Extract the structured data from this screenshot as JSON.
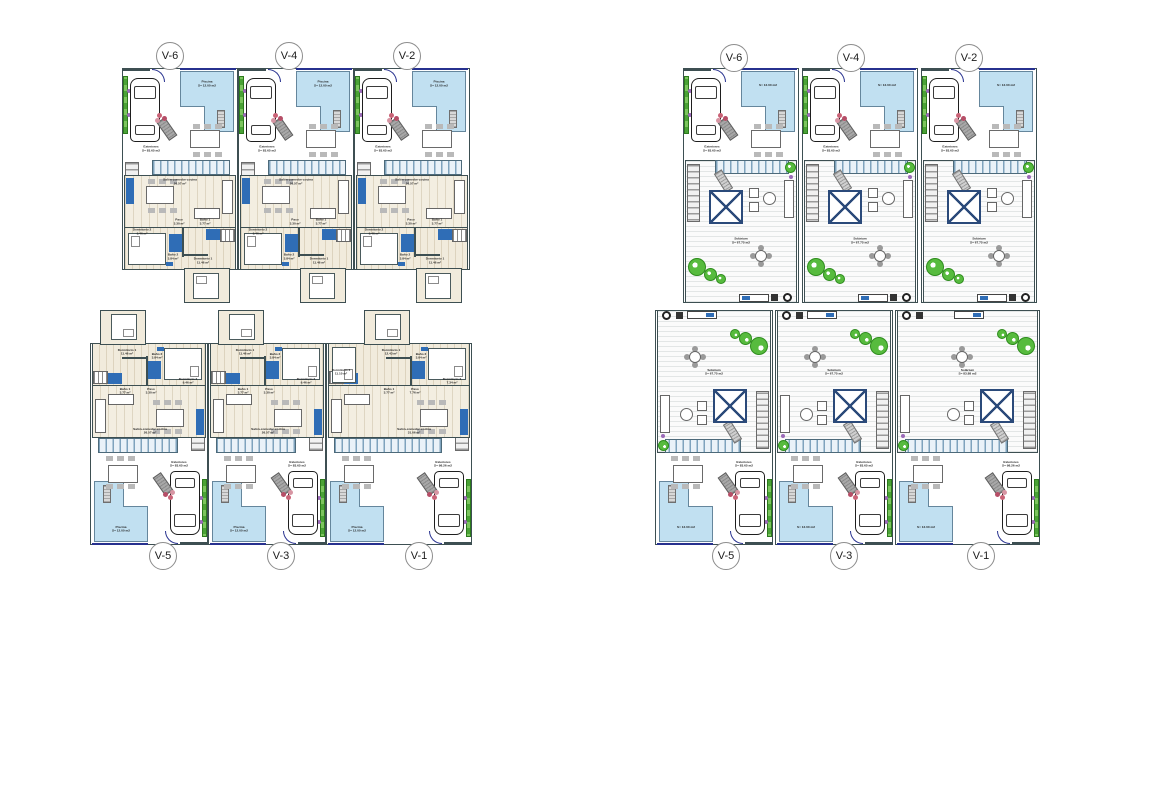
{
  "markers": {
    "top": [
      "V-6",
      "V-4",
      "V-2"
    ],
    "bottom": [
      "V-5",
      "V-3",
      "V-1"
    ]
  },
  "ground": {
    "standard_rooms": {
      "piscina": "Piscina\nS= 12.00 m2",
      "exteriores": "Exteriores\nS= 83.65 m2",
      "salon": "Salón-comedor-cocina\n26.57 m²",
      "paso": "Paso\n3.30 m²",
      "bano1": "Baño 1\n3.77 m²",
      "bano2": "Baño 2\n3.84 m²",
      "dorm1": "Dormitorio 1\n11.46 m²",
      "dorm2": "Dormitorio 2\n9.46 m²"
    },
    "v1_rooms": {
      "piscina": "Piscina\nS= 12.00 m2",
      "exteriores": "Exteriores\nS= 98.26 m2",
      "salon": "Salón-comedor-cocina\n31.06 m²",
      "paso": "Paso\n7.76 m²",
      "bano1": "Baño 1\n3.77 m²",
      "bano2": "Baño 2\n3.84 m²",
      "dorm1": "Dormitorio 1\n12.43 m²",
      "dorm2": "Dormitorio 2\n7.34 m²",
      "dorm3": "Dormitorio 3\n11.10 m²"
    }
  },
  "solarium": {
    "standard_rooms": {
      "solarium": "Solárium\nS= 67.75 m2",
      "exteriores": "Exteriores\nS= 83.65 m2",
      "piscina": "S= 12.00 m2"
    },
    "v1_rooms": {
      "solarium": "Solárium\nS= 83.88 m2",
      "exteriores": "Exteriores\nS= 98.26 m2",
      "piscina": "S= 12.00 m2"
    }
  },
  "colors": {
    "wall": "#3d4f52",
    "pool_blue": "#c1e0f1",
    "fixture_blue": "#2f6db6",
    "plant_green": "#57bb3e",
    "accent_purple": "#9b6ab8",
    "floor_beige": "#f1ebdc"
  }
}
